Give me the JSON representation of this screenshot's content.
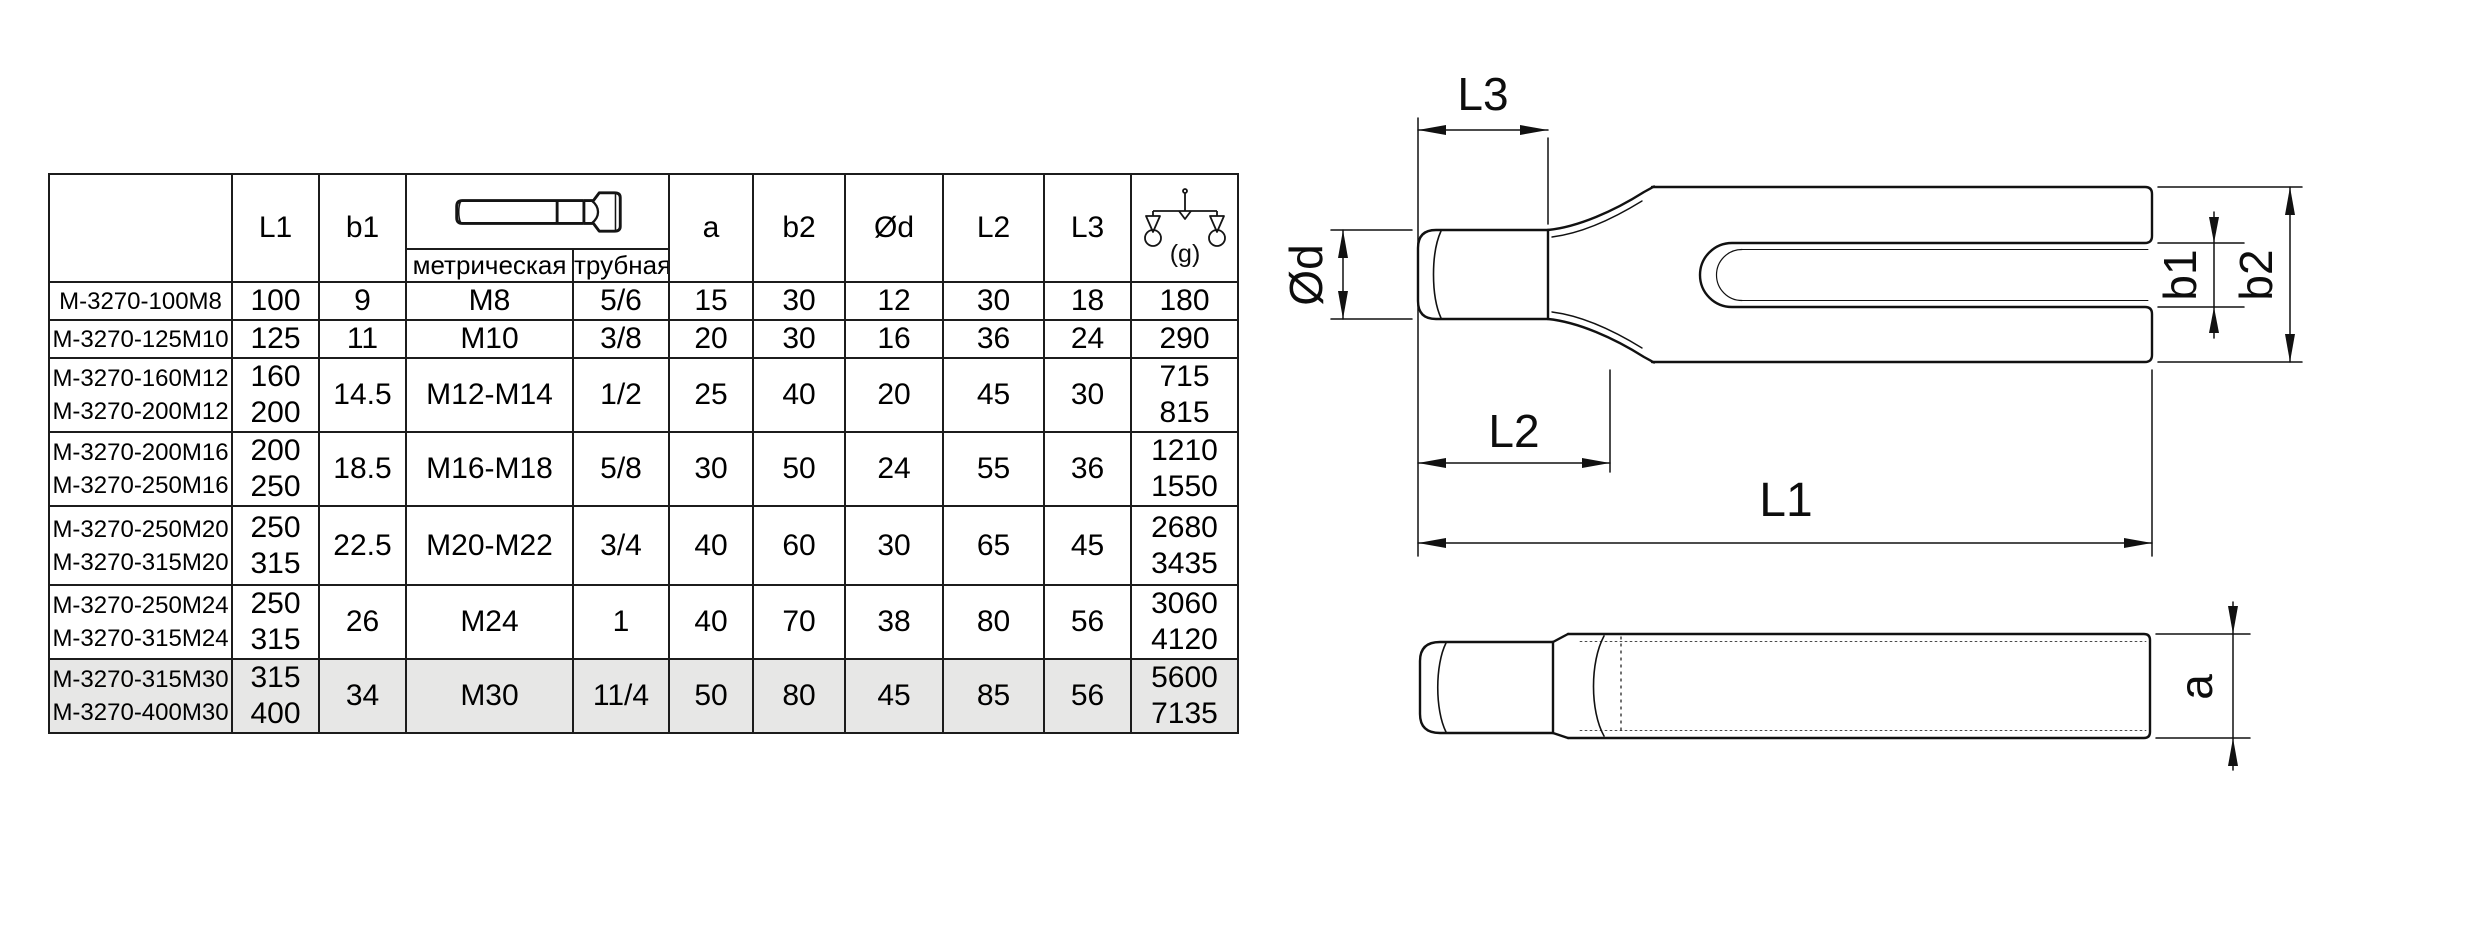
{
  "colors": {
    "line": "#111111",
    "text": "#000000",
    "highlight_row": "#e7e7e6",
    "background": "#ffffff"
  },
  "table": {
    "col_headers": {
      "part": "",
      "L1": "L1",
      "b1": "b1",
      "metric": "метрическая",
      "pipe": "трубная",
      "a": "a",
      "b2": "b2",
      "d": "Ød",
      "L2": "L2",
      "L3": "L3",
      "weight_unit": "(g)"
    },
    "icons": {
      "thread_icon": "t-bolt-side-view",
      "weight_icon": "balance-scale"
    },
    "rows": [
      {
        "names": [
          "M-3270-100M8"
        ],
        "L1": [
          "100"
        ],
        "b1": "9",
        "metric": "M8",
        "pipe": "5/6",
        "a": "15",
        "b2": "30",
        "d": "12",
        "L2": "30",
        "L3": "18",
        "weight": [
          "180"
        ]
      },
      {
        "names": [
          "M-3270-125M10"
        ],
        "L1": [
          "125"
        ],
        "b1": "11",
        "metric": "M10",
        "pipe": "3/8",
        "a": "20",
        "b2": "30",
        "d": "16",
        "L2": "36",
        "L3": "24",
        "weight": [
          "290"
        ]
      },
      {
        "names": [
          "M-3270-160M12",
          "M-3270-200M12"
        ],
        "L1": [
          "160",
          "200"
        ],
        "b1": "14.5",
        "metric": "M12-M14",
        "pipe": "1/2",
        "a": "25",
        "b2": "40",
        "d": "20",
        "L2": "45",
        "L3": "30",
        "weight": [
          "715",
          "815"
        ]
      },
      {
        "names": [
          "M-3270-200M16",
          "M-3270-250M16"
        ],
        "L1": [
          "200",
          "250"
        ],
        "b1": "18.5",
        "metric": "M16-M18",
        "pipe": "5/8",
        "a": "30",
        "b2": "50",
        "d": "24",
        "L2": "55",
        "L3": "36",
        "weight": [
          "1210",
          "1550"
        ]
      },
      {
        "names": [
          "M-3270-250M20",
          "M-3270-315M20"
        ],
        "L1": [
          "250",
          "315"
        ],
        "b1": "22.5",
        "metric": "M20-M22",
        "pipe": "3/4",
        "a": "40",
        "b2": "60",
        "d": "30",
        "L2": "65",
        "L3": "45",
        "weight": [
          "2680",
          "3435"
        ]
      },
      {
        "names": [
          "M-3270-250M24",
          "M-3270-315M24"
        ],
        "L1": [
          "250",
          "315"
        ],
        "b1": "26",
        "metric": "M24",
        "pipe": "1",
        "a": "40",
        "b2": "70",
        "d": "38",
        "L2": "80",
        "L3": "56",
        "weight": [
          "3060",
          "4120"
        ]
      },
      {
        "names": [
          "M-3270-315M30",
          "M-3270-400M30"
        ],
        "L1": [
          "315",
          "400"
        ],
        "b1": "34",
        "metric": "M30",
        "pipe": "11/4",
        "a": "50",
        "b2": "80",
        "d": "45",
        "L2": "85",
        "L3": "56",
        "weight": [
          "5600",
          "7135"
        ],
        "highlight": true
      }
    ]
  },
  "drawings": {
    "labels": {
      "L3": "L3",
      "d": "Ød",
      "L2": "L2",
      "L1": "L1",
      "b1": "b1",
      "b2": "b2",
      "a": "a"
    }
  }
}
